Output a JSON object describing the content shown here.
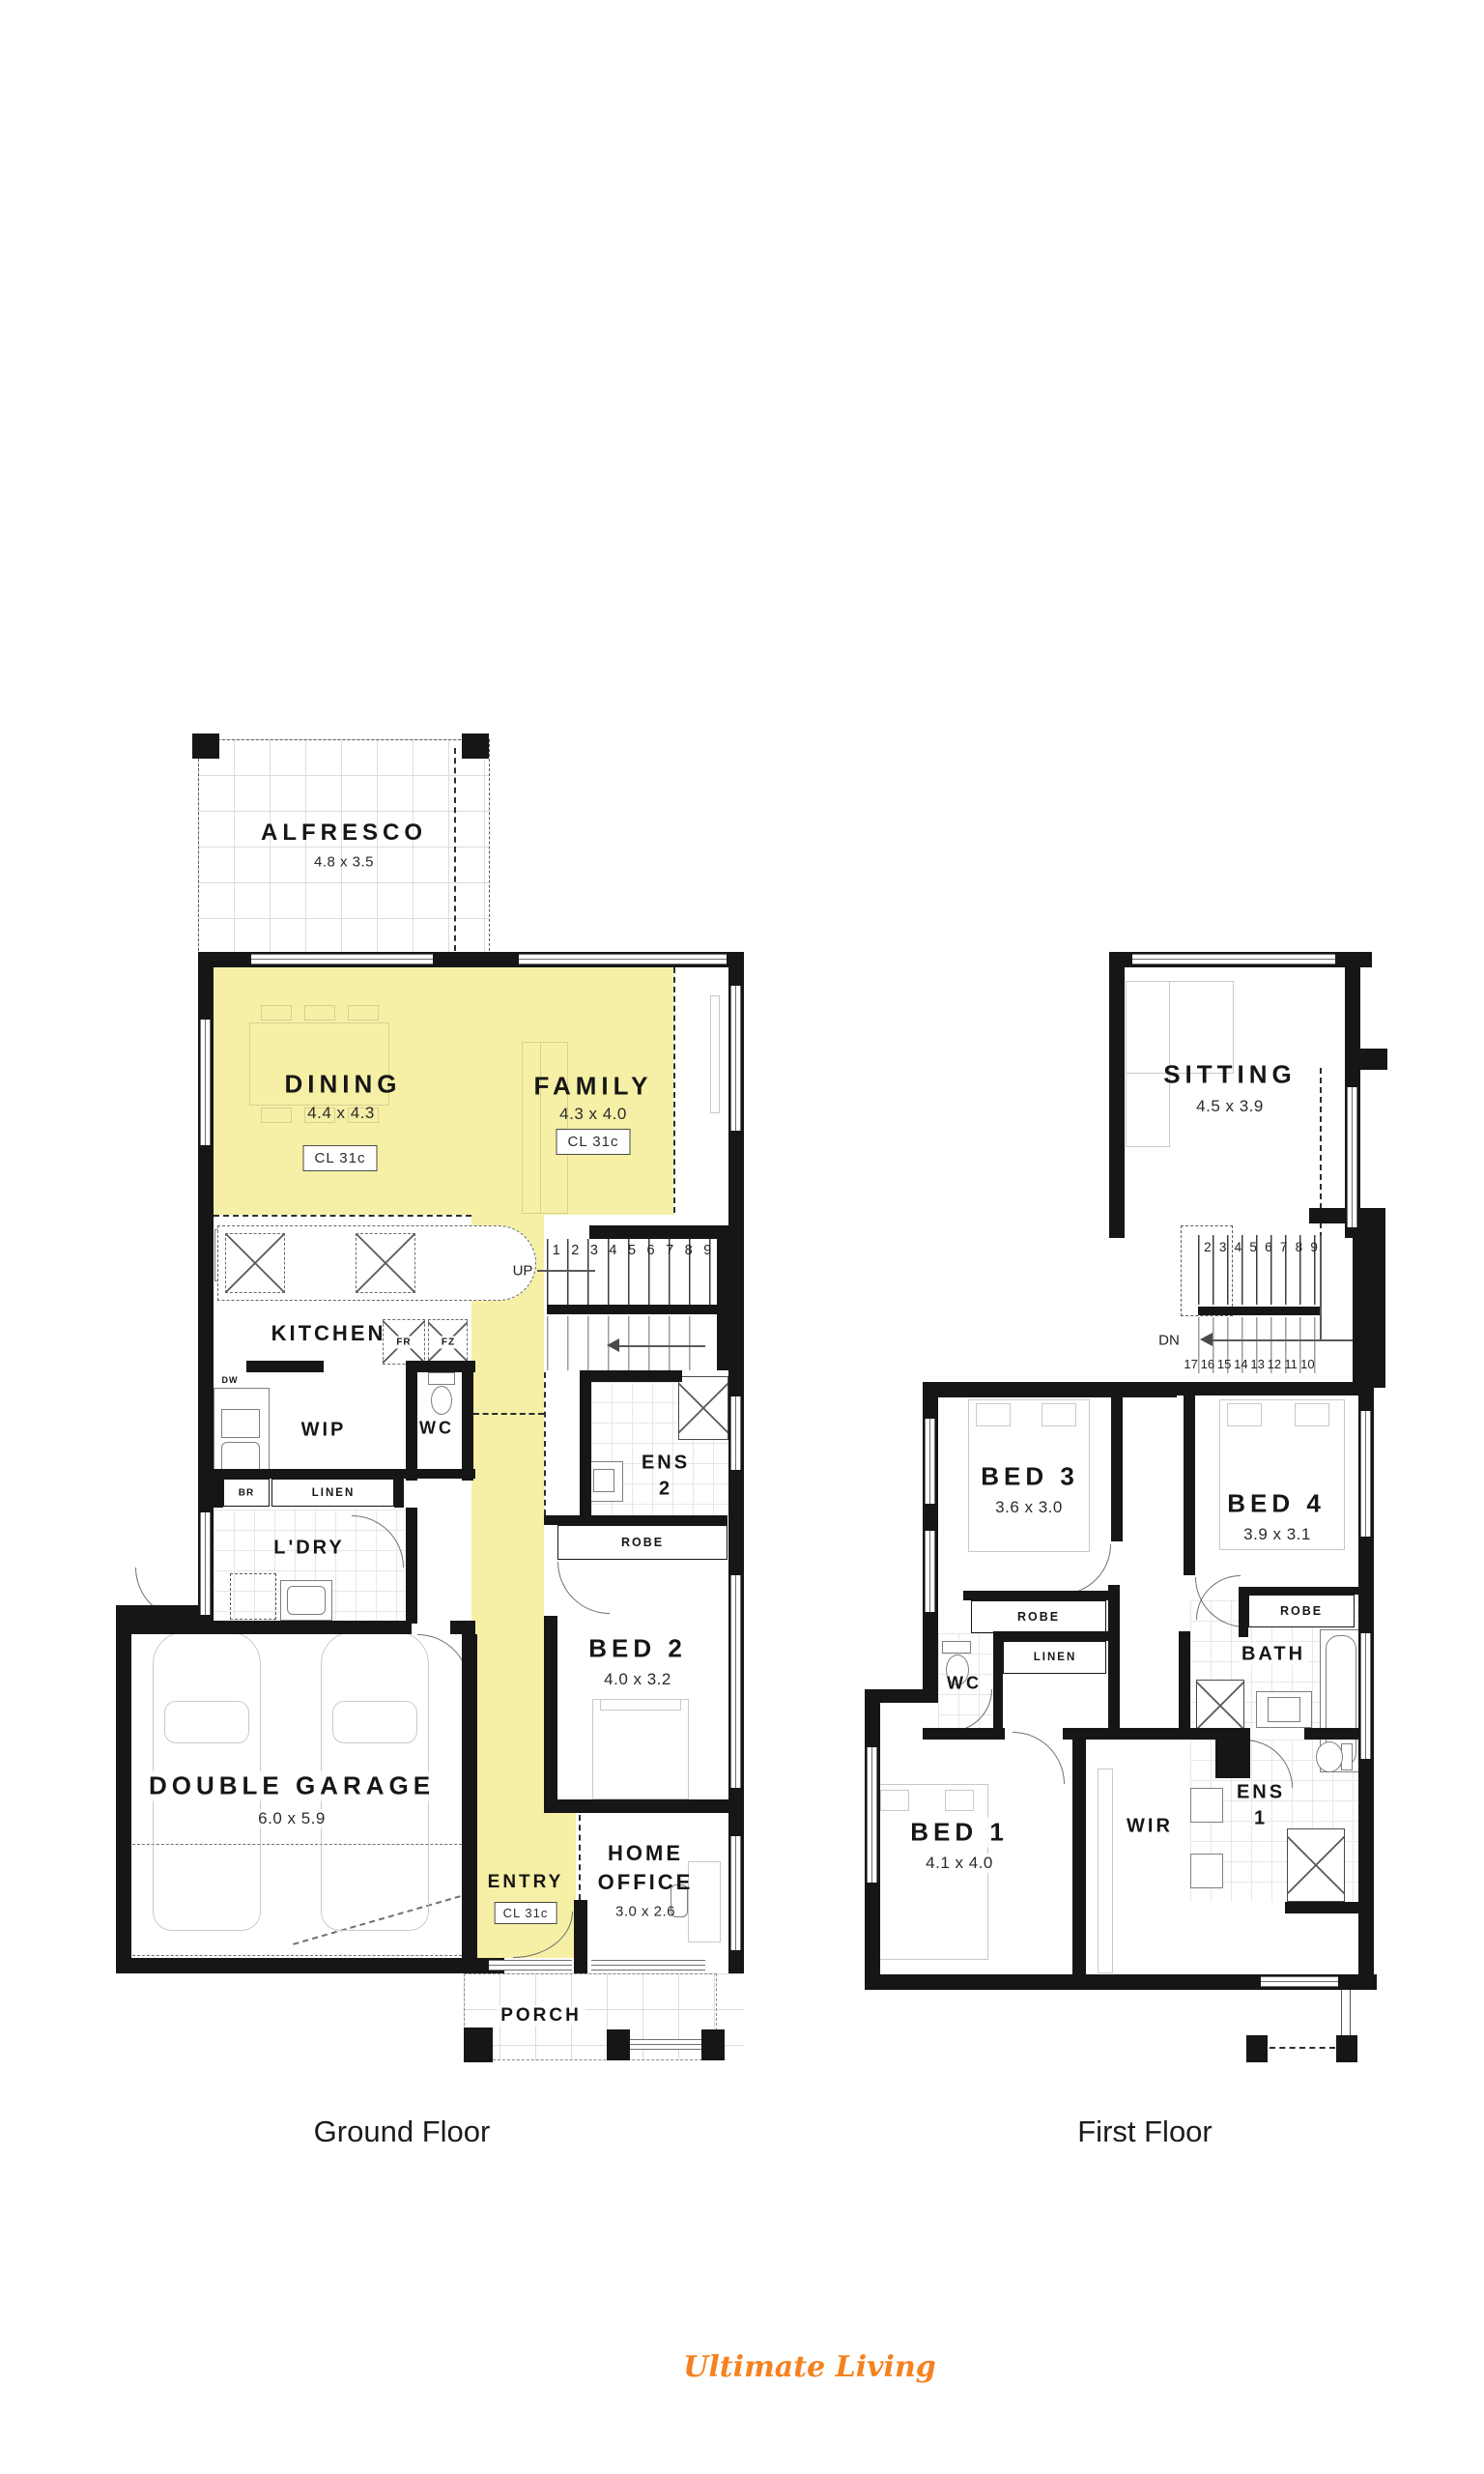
{
  "colors": {
    "highlight": "#F6F0A6",
    "wall": "#161616",
    "logo_orange": "#F5821F"
  },
  "captions": {
    "ground": "Ground Floor",
    "first": "First Floor"
  },
  "logo": {
    "text": "Ultimate Living"
  },
  "gf": {
    "alfresco": {
      "name": "ALFRESCO",
      "dims": "4.8 x 3.5"
    },
    "dining": {
      "name": "DINING",
      "dims": "4.4 x 4.3",
      "cl": "CL 31c"
    },
    "family": {
      "name": "FAMILY",
      "dims": "4.3 x 4.0",
      "cl": "CL 31c"
    },
    "kitchen": {
      "name": "KITCHEN"
    },
    "labels": {
      "fr": "FR",
      "fz": "FZ",
      "dw": "DW",
      "br": "BR",
      "linen": "LINEN",
      "robe": "ROBE",
      "up": "UP"
    },
    "wip": {
      "name": "WIP"
    },
    "wc": {
      "name": "WC"
    },
    "ens2": {
      "line1": "ENS",
      "line2": "2"
    },
    "ldry": {
      "name": "L'DRY"
    },
    "bed2": {
      "name": "BED 2",
      "dims": "4.0 x 3.2"
    },
    "garage": {
      "name": "DOUBLE GARAGE",
      "dims": "6.0 x 5.9"
    },
    "entry": {
      "name": "ENTRY",
      "cl": "CL 31c"
    },
    "office": {
      "line1": "HOME",
      "line2": "OFFICE",
      "dims": "3.0 x 2.6"
    },
    "porch": {
      "name": "PORCH"
    },
    "stairs": {
      "numbers": [
        "1",
        "2",
        "3",
        "4",
        "5",
        "6",
        "7",
        "8",
        "9"
      ]
    }
  },
  "ff": {
    "sitting": {
      "name": "SITTING",
      "dims": "4.5 x 3.9"
    },
    "stairs": {
      "dn": "DN",
      "top": [
        "2",
        "3",
        "4",
        "5",
        "6",
        "7",
        "8",
        "9"
      ],
      "bottom": [
        "17",
        "16",
        "15",
        "14",
        "13",
        "12",
        "11",
        "10"
      ]
    },
    "bed3": {
      "name": "BED 3",
      "dims": "3.6 x 3.0"
    },
    "bed4": {
      "name": "BED 4",
      "dims": "3.9 x 3.1"
    },
    "labels": {
      "robe3": "ROBE",
      "robe4": "ROBE",
      "linen": "LINEN"
    },
    "wc": {
      "name": "WC"
    },
    "bath": {
      "name": "BATH"
    },
    "bed1": {
      "name": "BED 1",
      "dims": "4.1 x 4.0"
    },
    "wir": {
      "name": "WIR"
    },
    "ens1": {
      "line1": "ENS",
      "line2": "1"
    }
  }
}
